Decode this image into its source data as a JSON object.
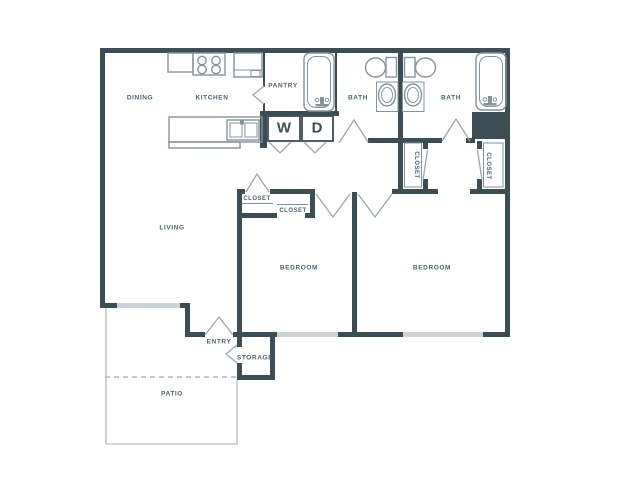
{
  "figure": {
    "type": "floor-plan",
    "description": "Two bedroom / two bath apartment floor plan with patio"
  },
  "colors": {
    "wall": "#3d4d54",
    "window": "#cdd2d4",
    "fixture": "#84939b",
    "door": "#9aa7ac",
    "patio": "#b3bcbf",
    "label": "#4c616b",
    "bg": "#ffffff"
  },
  "rooms": {
    "dining": "DINING",
    "kitchen": "KITCHEN",
    "pantry": "PANTRY",
    "bath1": "BATH",
    "bath2": "BATH",
    "living": "LIVING",
    "closet_living": "CLOSET",
    "closet_bedroom1": "CLOSET",
    "closet_hall_left": "CLOSET",
    "closet_hall_right": "CLOSET",
    "bedroom1": "BEDROOM",
    "bedroom2": "BEDROOM",
    "entry": "ENTRY",
    "storage": "STORAGE",
    "patio": "PATIO"
  },
  "appliances": {
    "washer": "W",
    "dryer": "D"
  }
}
